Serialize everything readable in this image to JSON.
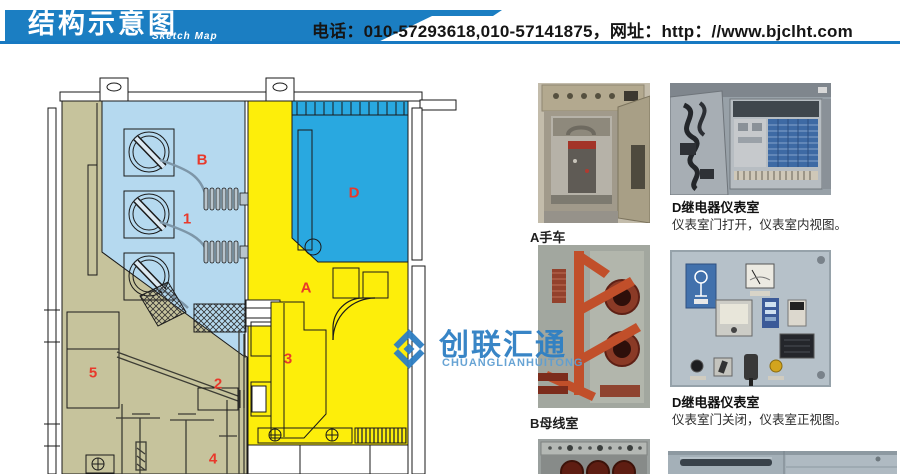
{
  "header": {
    "title": "结构示意图",
    "subtitle": "Sketch Map",
    "contact": "电话：010-57293618,010-57141875，网址：http：//www.bjclht.com",
    "banner_color": "#1b7ec2"
  },
  "watermark": {
    "name_cn": "创联汇通",
    "name_en": "CHUANGLIANHUITONG",
    "color": "#2e7fc4"
  },
  "diagram": {
    "labels": [
      {
        "text": "B"
      },
      {
        "text": "1"
      },
      {
        "text": "D"
      },
      {
        "text": "A"
      },
      {
        "text": "3"
      },
      {
        "text": "2"
      },
      {
        "text": "5"
      },
      {
        "text": "4"
      }
    ],
    "colors": {
      "busbar_room": "#b5d9ef",
      "relay_room": "#29a8e0",
      "breaker_room": "#fdee0a",
      "cable_room": "#c6c39c",
      "label_red": "#e8392b"
    }
  },
  "photos": [
    {
      "caption": "A手车"
    },
    {
      "caption": "B母线室"
    },
    {
      "title": "D继电器仪表室",
      "desc": "仪表室门打开，仪表室内视图。"
    },
    {
      "title": "D继电器仪表室",
      "desc": "仪表室门关闭，仪表室正视图。"
    }
  ]
}
